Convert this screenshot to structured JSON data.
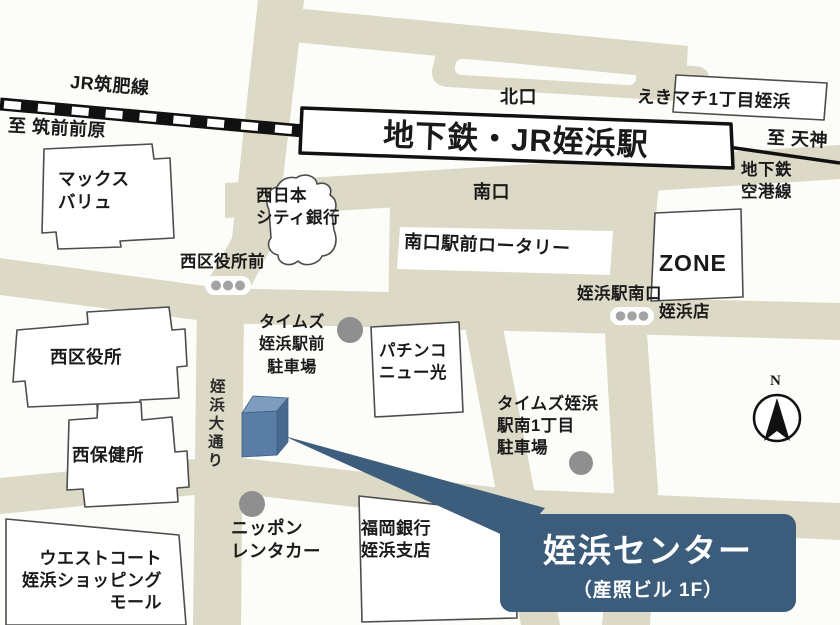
{
  "railway": {
    "jr_line": "JR筑肥線",
    "to_chikuzen_maebaru": "至 筑前前原",
    "to_tenjin": "至 天神",
    "subway_airport_line": "地下鉄\n空港線"
  },
  "station": {
    "name": "地下鉄・JR姪浜駅",
    "north_exit": "北口",
    "south_exit": "南口",
    "ekimachi_building": "えきマチ1丁目姪浜",
    "rotary": "南口駅前ロータリー"
  },
  "intersections": {
    "nishi_ward_office_front": "西区役所前",
    "station_south_exit": "姪浜駅南口"
  },
  "street": {
    "meinohama_odori": "姪浜大通り"
  },
  "buildings": {
    "max_valu": "マックス\nバリュ",
    "nishi_nippon_city_bank": "西日本\nシティ銀行",
    "zone_line1": "ZONE",
    "zone_line2": "姪浜店",
    "times_ekimae_parking": "タイムズ\n姪浜駅前\n駐車場",
    "pachinko_new_hikari": "パチンコ\nニュー光",
    "nishi_ward_office": "西区役所",
    "nishi_health_center": "西保健所",
    "times_minami_parking": "タイムズ姪浜\n駅南1丁目\n駐車場",
    "nippon_rentacar": "ニッポン\nレンタカー",
    "fukuoka_bank": "福岡銀行\n姪浜支店",
    "west_court_mall": "ウエストコート\n姪浜ショッピング\nモール"
  },
  "compass": {
    "north": "N"
  },
  "destination": {
    "name": "姪浜センター",
    "floor": "（産照ビル 1F）"
  },
  "colors": {
    "road": "#dcd9c6",
    "destination_label_bg": "#3b5c7b",
    "marker_front": "#5a7da5",
    "marker_top": "#7e9cbe",
    "marker_side": "#49688e",
    "parking_dot": "#8f8f8f"
  }
}
